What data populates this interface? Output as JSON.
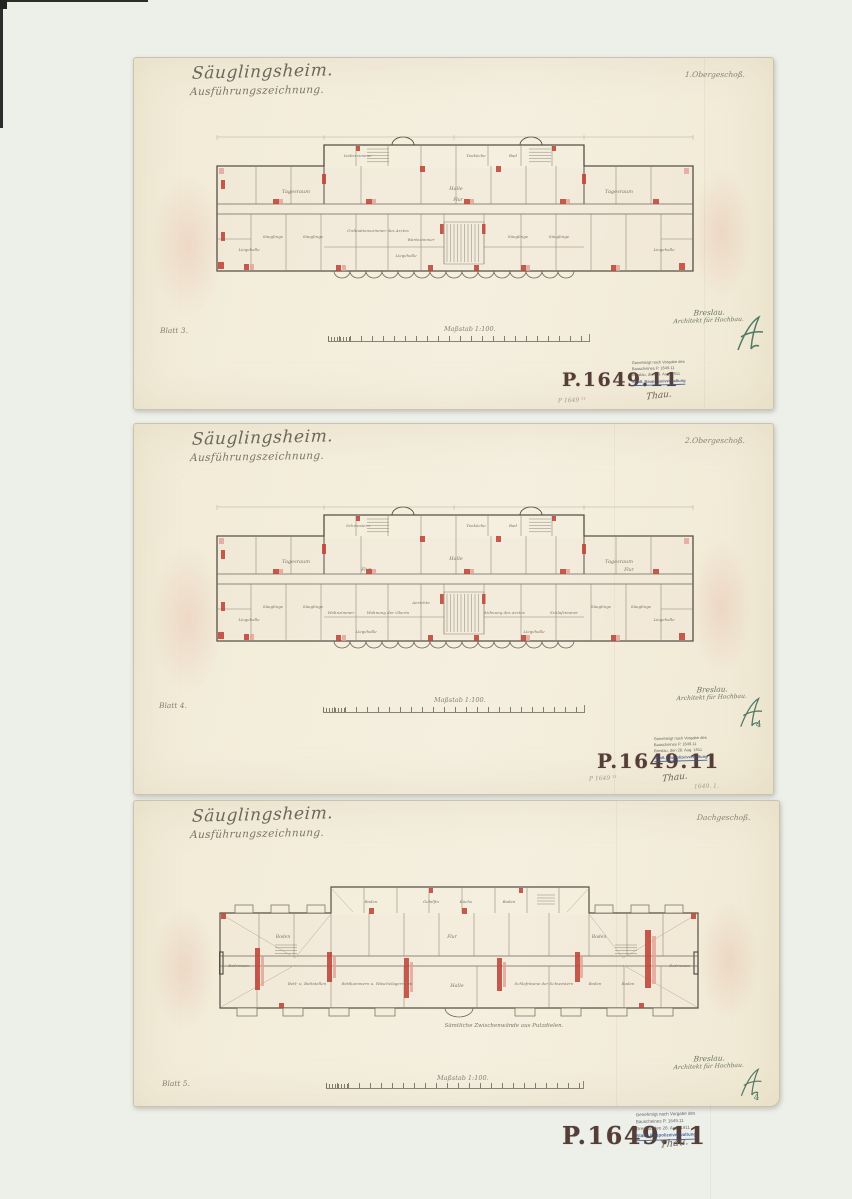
{
  "colors": {
    "paper": "#f3edda",
    "backing": "#edefe9",
    "stamp_ink": "#4a312b",
    "monogram_ink": "#3e6e59",
    "plan_red": "#bf4538",
    "approval_blue": "#31508e"
  },
  "sheets": [
    {
      "title": "Säuglingsheim.",
      "subtitle": "Ausführungszeichnung.",
      "floor_label": "1.Obergeschoß.",
      "sheet_number": "Blatt 3.",
      "scale_label": "Maßstab 1:100.",
      "signature": {
        "line1": "Breslau.",
        "line2": "Architekt für Hochbau."
      },
      "approval": {
        "stamp_number": "P.1649.11",
        "stamp_lines": [
          "Genehmigt nach Vorgabe des",
          "Bauscheines P. 1649.11",
          "Breslau, den 28. Aug. 1911",
          "Städt. Baupolizeiverwaltung"
        ],
        "handwritten": "Thau.",
        "pencil_note": "P 1649 ¹¹"
      },
      "plan": {
        "rooms": [
          "Tagesraum",
          "Tagesraum",
          "Halle",
          "Flur",
          "Säuglinge",
          "Säuglinge",
          "Säuglinge",
          "Säuglinge",
          "Ordinationszimmer des Arztes",
          "Wartezimmer",
          "Liegehalle",
          "Liegehalle",
          "Liegehalle",
          "Isolierzimmer",
          "Teeküche",
          "Bad"
        ]
      }
    },
    {
      "title": "Säuglingsheim.",
      "subtitle": "Ausführungszeichnung.",
      "floor_label": "2.Obergeschoß.",
      "sheet_number": "Blatt 4.",
      "scale_label": "Maßstab 1:100.",
      "signature": {
        "line1": "Breslau.",
        "line2": "Architekt für Hochbau."
      },
      "monogram_extra": "4",
      "approval": {
        "stamp_number": "P.1649.11",
        "stamp_lines": [
          "Genehmigt nach Vorgabe des",
          "Bauscheines P. 1649.11",
          "Breslau, den 28. Aug. 1911",
          "Städt. Baupolizeiverwaltung"
        ],
        "handwritten": "Thau.",
        "pencil_note": "P 1649 ¹¹",
        "pencil_note_right": "1649. 1."
      },
      "plan": {
        "rooms": [
          "Tagesraum",
          "Tagesraum",
          "Halle",
          "Flur",
          "Flur",
          "Säuglinge",
          "Säuglinge",
          "Säuglinge",
          "Säuglinge",
          "Anrichte",
          "Wohnzimmer",
          "Wohnung der Oberin",
          "Wohnung des Arztes",
          "Schlafzimmer",
          "Liegehalle",
          "Liegehalle",
          "Liegehalle",
          "Liegehalle",
          "Schwestern",
          "Teeküche",
          "Bad"
        ]
      }
    },
    {
      "title": "Säuglingsheim.",
      "subtitle": "Ausführungszeichnung.",
      "floor_label": "Dachgeschoß.",
      "sheet_number": "Blatt 5.",
      "scale_label": "Maßstab 1:100.",
      "signature": {
        "line1": "Breslau.",
        "line2": "Architekt für Hochbau."
      },
      "monogram_extra": "4",
      "approval": {
        "stamp_number": "P.1649.11",
        "stamp_lines": [
          "Genehmigt nach Vorgabe des",
          "Bauscheines P. 1649.11",
          "Breslau, den 28. Aug. 1911",
          "Städt. Baupolizeiverwaltung"
        ],
        "handwritten": "Thau."
      },
      "plan": {
        "rooms": [
          "Bodenraum",
          "Boden",
          "Flur",
          "Halle",
          "Bett- u. Bettstellen",
          "Bettkammern u. Wäschelagerraum",
          "Schlafräume der Schwestern",
          "Boden",
          "Boden",
          "Boden",
          "Bodenraum",
          "Gehilfin",
          "Küche",
          "Boden",
          "Boden"
        ],
        "note": "Sämtliche Zwischenwände aus Putzdielen."
      }
    }
  ]
}
